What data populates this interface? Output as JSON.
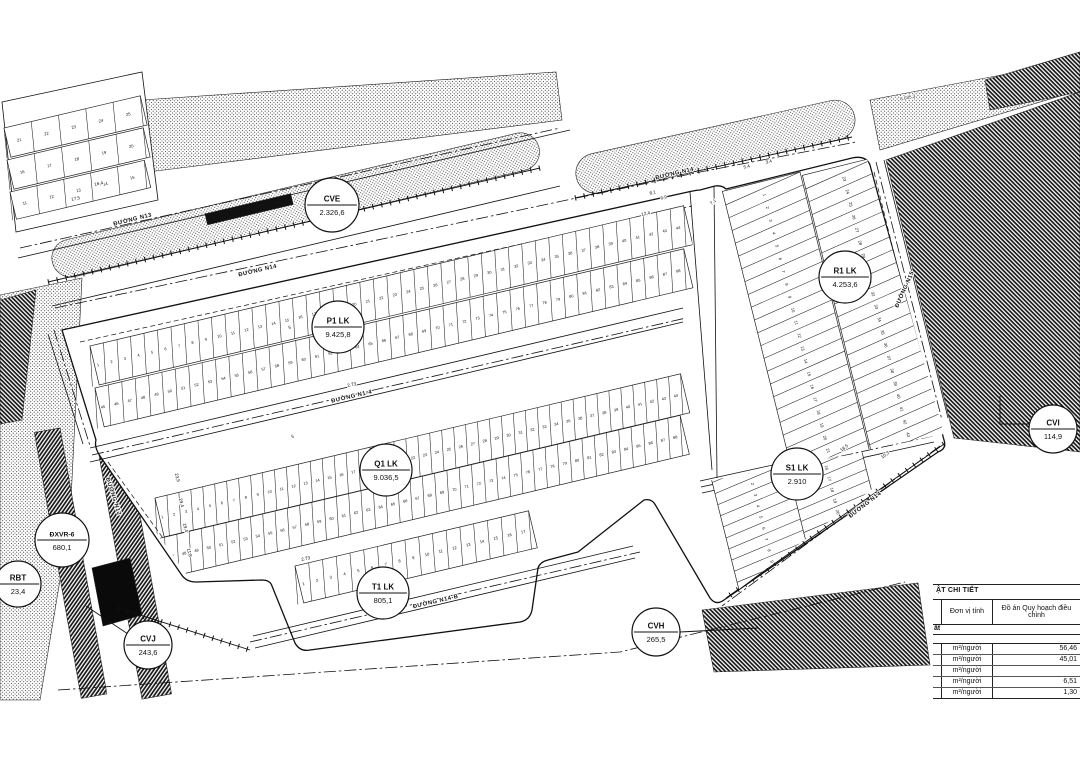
{
  "map": {
    "balloons": [
      {
        "id": "cve",
        "code": "CVE",
        "value": "2.326,6"
      },
      {
        "id": "p1",
        "code": "P1 LK",
        "value": "9.425,8"
      },
      {
        "id": "q1",
        "code": "Q1 LK",
        "value": "9.036,5"
      },
      {
        "id": "r1",
        "code": "R1 LK",
        "value": "4.253,6"
      },
      {
        "id": "s1",
        "code": "S1 LK",
        "value": "2.910"
      },
      {
        "id": "t1",
        "code": "T1 LK",
        "value": "805,1"
      },
      {
        "id": "cvh",
        "code": "CVH",
        "value": "265,5"
      },
      {
        "id": "cvj",
        "code": "CVJ",
        "value": "243,6"
      },
      {
        "id": "cvi",
        "code": "CVI",
        "value": "114,9"
      },
      {
        "id": "dxvr",
        "code": "ĐXVR-6",
        "value": "680,1"
      },
      {
        "id": "rbt",
        "code": "RBT",
        "value": "23,4"
      }
    ],
    "road_labels": [
      {
        "id": "n13",
        "text": "ĐƯỜNG N13"
      },
      {
        "id": "n14a",
        "text": "ĐƯỜNG N14"
      },
      {
        "id": "n14b",
        "text": "ĐƯỜNG N14"
      },
      {
        "id": "n1_4",
        "text": "ĐƯỜNG N1-4"
      },
      {
        "id": "n14_b",
        "text": "ĐƯỜNG N14-B"
      },
      {
        "id": "n14c",
        "text": "ĐƯỜNG N14"
      },
      {
        "id": "n15",
        "text": "ĐƯỜNG N15"
      },
      {
        "id": "n12",
        "text": "ĐƯỜNG N12"
      }
    ],
    "annotations": [
      {
        "id": "a1",
        "text": "6.035,3"
      },
      {
        "id": "a2",
        "text": "17,5"
      },
      {
        "id": "a3",
        "text": "16,4"
      },
      {
        "id": "a4",
        "text": "2.73"
      },
      {
        "id": "a5",
        "text": "23,5"
      },
      {
        "id": "a6",
        "text": "29,4"
      },
      {
        "id": "a7",
        "text": "19,4"
      },
      {
        "id": "a8",
        "text": "11,8"
      },
      {
        "id": "a9",
        "text": "5,4"
      },
      {
        "id": "a10",
        "text": "3,4"
      },
      {
        "id": "a11",
        "text": "7,1"
      },
      {
        "id": "a12",
        "text": "12,4"
      },
      {
        "id": "a13",
        "text": "8,1"
      },
      {
        "id": "a14",
        "text": "6,9"
      },
      {
        "id": "a15",
        "text": "5"
      },
      {
        "id": "a16",
        "text": "5"
      },
      {
        "id": "a17",
        "text": "18,5"
      },
      {
        "id": "a18",
        "text": "10,3"
      },
      {
        "id": "a19",
        "text": "2.73"
      }
    ],
    "lot_bands": [
      {
        "id": "tl_a",
        "from": 21,
        "to": 25
      },
      {
        "id": "tl_b",
        "from": 16,
        "to": 20
      },
      {
        "id": "tl_c",
        "from": 11,
        "to": 15
      },
      {
        "id": "p1_upper",
        "from": 1,
        "to": 44
      },
      {
        "id": "p1_lower",
        "from": 45,
        "to": 88
      },
      {
        "id": "q1_upper",
        "from": 1,
        "to": 44
      },
      {
        "id": "q1_lower",
        "from": 45,
        "to": 88
      },
      {
        "id": "t1",
        "from": 1,
        "to": 17
      },
      {
        "id": "r1_a",
        "from": 1,
        "to": 22
      },
      {
        "id": "r1_b",
        "from": 23,
        "to": 44
      },
      {
        "id": "s1_a",
        "from": 1,
        "to": 14
      },
      {
        "id": "s1_b",
        "from": 15,
        "to": 28
      }
    ]
  },
  "table": {
    "title": "ẬT CHI TIẾT",
    "col_unit": "Đơn vị tính",
    "col_plan": "Đồ án Quy hoạch điều chỉnh",
    "section_row": "ất",
    "rows": [
      {
        "unit": "m²/người",
        "value": "56,46"
      },
      {
        "unit": "m²/người",
        "value": "45,01"
      },
      {
        "unit": "m²/người",
        "value": ""
      },
      {
        "unit": "m²/người",
        "value": "6,51"
      },
      {
        "unit": "m²/người",
        "value": "1,30"
      }
    ]
  },
  "colors": {
    "ink": "#111111",
    "paper": "#ffffff"
  }
}
